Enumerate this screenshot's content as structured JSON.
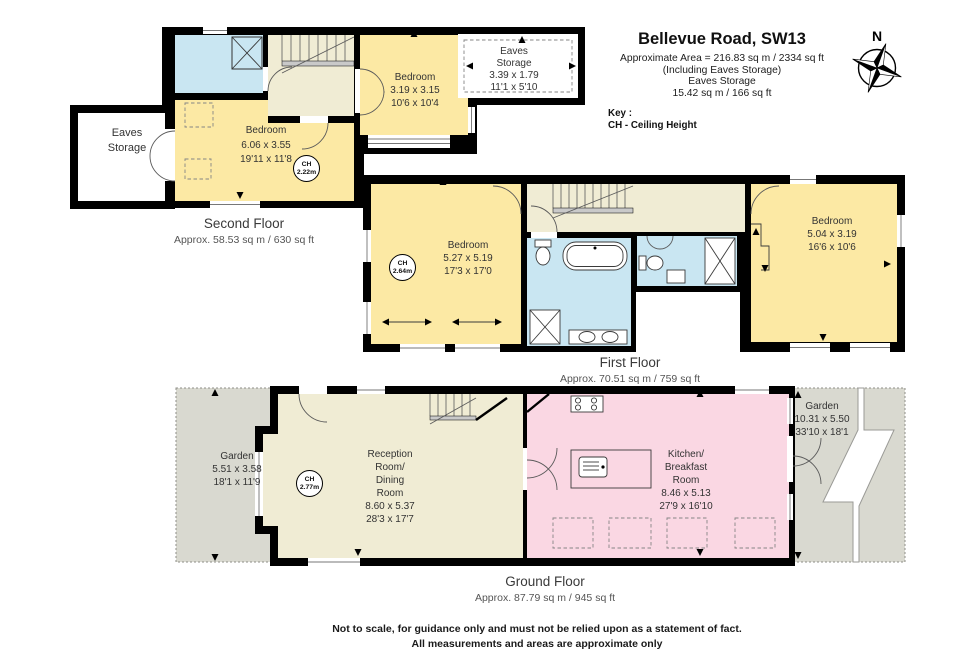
{
  "header": {
    "title": "Bellevue Road, SW13",
    "area_lines": [
      "Approximate Area = 216.83 sq m / 2334 sq ft",
      "(Including Eaves Storage)",
      "Eaves Storage",
      "15.42 sq m / 166 sq ft"
    ],
    "key_label": "Key :",
    "key_text": "CH - Ceiling Height",
    "compass": "N"
  },
  "second_floor": {
    "title": "Second Floor",
    "area": "Approx. 58.53 sq m / 630 sq ft",
    "eaves_left": {
      "l1": "Eaves",
      "l2": "Storage"
    },
    "bedroom_main": {
      "name": "Bedroom",
      "metric": "6.06 x 3.55",
      "imperial": "19'11 x 11'8",
      "ch_label": "CH",
      "ch_value": "2.22m"
    },
    "bedroom_small": {
      "name": "Bedroom",
      "metric": "3.19 x 3.15",
      "imperial": "10'6 x 10'4"
    },
    "eaves_right": {
      "l1": "Eaves",
      "l2": "Storage",
      "metric": "3.39 x 1.79",
      "imperial": "11'1 x 5'10"
    }
  },
  "first_floor": {
    "title": "First Floor",
    "area": "Approx. 70.51 sq m / 759 sq ft",
    "bedroom_left": {
      "name": "Bedroom",
      "metric": "5.27 x 5.19",
      "imperial": "17'3 x 17'0",
      "ch_label": "CH",
      "ch_value": "2.64m"
    },
    "bedroom_right": {
      "name": "Bedroom",
      "metric": "5.04 x 3.19",
      "imperial": "16'6 x 10'6"
    }
  },
  "ground_floor": {
    "title": "Ground Floor",
    "area": "Approx. 87.79 sq m / 945 sq ft",
    "garden_left": {
      "name": "Garden",
      "metric": "5.51 x 3.58",
      "imperial": "18'1 x 11'9"
    },
    "reception": {
      "l1": "Reception",
      "l2": "Room/",
      "l3": "Dining",
      "l4": "Room",
      "metric": "8.60 x 5.37",
      "imperial": "28'3 x 17'7",
      "ch_label": "CH",
      "ch_value": "2.77m"
    },
    "kitchen": {
      "l1": "Kitchen/",
      "l2": "Breakfast",
      "l3": "Room",
      "metric": "8.46 x 5.13",
      "imperial": "27'9 x 16'10"
    },
    "garden_right": {
      "name": "Garden",
      "metric": "10.31 x 5.50",
      "imperial": "33'10 x 18'1"
    }
  },
  "footer": {
    "line1": "Not to scale, for guidance only and must not be relied upon as a statement of fact.",
    "line2": "All measurements and areas are approximate only"
  },
  "colors": {
    "wall": "#000000",
    "bedroom": "#FCE9A4",
    "bathroom": "#C9E6F2",
    "landing": "#F0ECD4",
    "kitchen": "#FAD7E3",
    "garden": "#D9D9D0",
    "stair_tread": "#C9C9C9"
  }
}
